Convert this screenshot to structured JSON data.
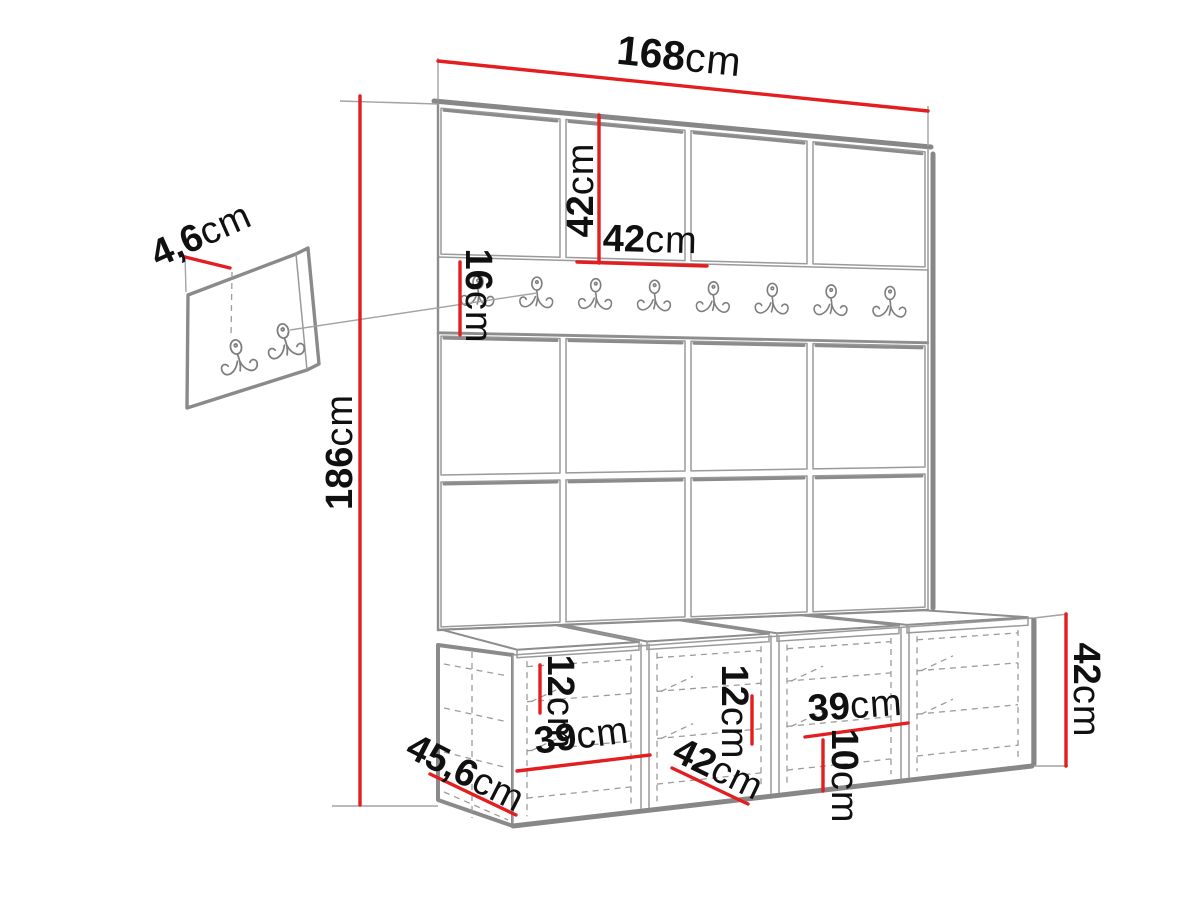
{
  "colors": {
    "dimension_red": "#e41e20"
  },
  "diagram": {
    "description": "hallway furniture set dimensional drawing",
    "wall": {
      "columns": 4,
      "panel_rows": 3
    },
    "hook_rail": {
      "hook_count": 8
    },
    "accessory_panel": {
      "hook_count": 2
    },
    "bench": {
      "compartment_count": 4,
      "cushion_count": 4
    },
    "dimensions": {
      "total_width": {
        "value": "168",
        "unit": "cm"
      },
      "top_panel_height": {
        "value": "42",
        "unit": "cm"
      },
      "top_panel_width": {
        "value": "42",
        "unit": "cm"
      },
      "rail_height": {
        "value": "16",
        "unit": "cm"
      },
      "total_height": {
        "value": "186",
        "unit": "cm"
      },
      "wall_panel_depth": {
        "value": "4,6",
        "unit": "cm"
      },
      "bench_depth": {
        "value": "45,6",
        "unit": "cm"
      },
      "compartment1_width": {
        "value": "39",
        "unit": "cm"
      },
      "compartment1_shelf": {
        "value": "12",
        "unit": "cm"
      },
      "compartment2_width": {
        "value": "42",
        "unit": "cm"
      },
      "compartment2_shelf": {
        "value": "12",
        "unit": "cm"
      },
      "compartment3_width": {
        "value": "39",
        "unit": "cm"
      },
      "compartment3_offset": {
        "value": "10",
        "unit": "cm"
      },
      "bench_height": {
        "value": "42",
        "unit": "cm"
      }
    }
  }
}
